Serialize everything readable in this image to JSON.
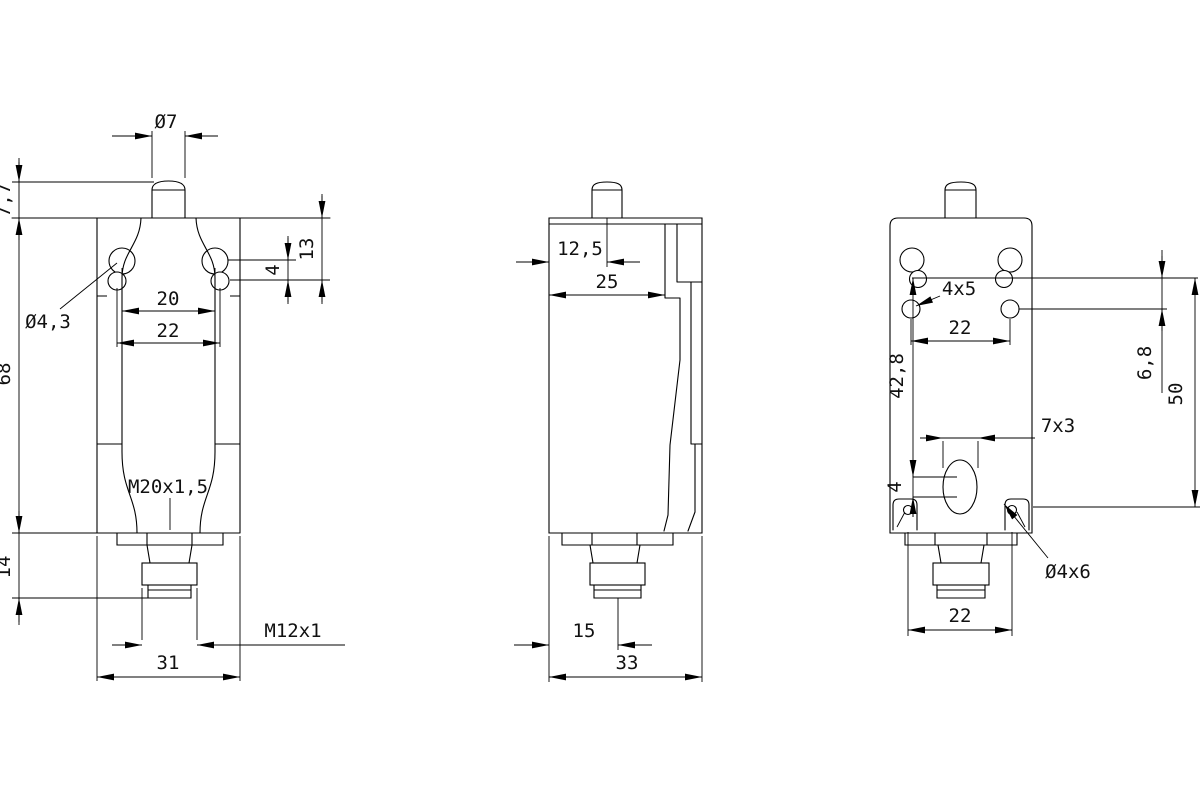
{
  "drawing": {
    "title": "limit-switch-dimension-drawing",
    "units": "mm",
    "line_color": "#000000",
    "background": "#ffffff",
    "views": {
      "front": {
        "dims": {
          "plunger_diameter": "Ø7",
          "plunger_travel": "7,7",
          "body_height": "68",
          "slot_depth": "13",
          "slot_offset": "4",
          "slot_hole_diameter": "Ø4,3",
          "slot_pitch_upper": "20",
          "slot_pitch_lower": "22",
          "gland_thread": "M20x1,5",
          "connector_length": "14",
          "connector_thread": "M12x1",
          "body_width": "31"
        }
      },
      "side": {
        "dims": {
          "plunger_offset": "12,5",
          "head_depth": "25",
          "connector_offset": "15",
          "overall_depth": "33"
        }
      },
      "rear": {
        "dims": {
          "keyway_size": "4x5",
          "hole_pitch": "22",
          "hole_height": "42,8",
          "row_gap": "6,8",
          "mount_span": "50",
          "lower_slot": "7x3",
          "lower_slot_offset": "4",
          "corner_hole": "Ø4x6",
          "bottom_hole_pitch": "22"
        }
      }
    }
  }
}
